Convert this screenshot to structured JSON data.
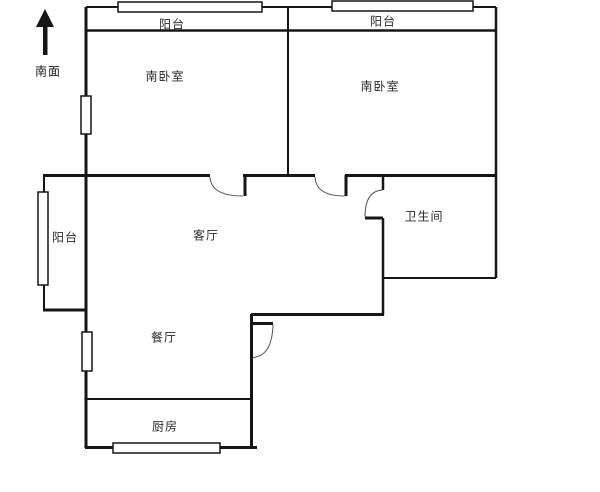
{
  "meta": {
    "type": "floor-plan",
    "orientation_note": "arrow points toward labeled side"
  },
  "compass": {
    "label": "南面",
    "icon": "up-arrow"
  },
  "rooms": {
    "balcony_top_left": {
      "label": "阳台"
    },
    "balcony_top_right": {
      "label": "阳台"
    },
    "bedroom_left": {
      "label": "南卧室"
    },
    "bedroom_right": {
      "label": "南卧室"
    },
    "balcony_left": {
      "label": "阳台"
    },
    "living": {
      "label": "客厅"
    },
    "bathroom": {
      "label": "卫生间"
    },
    "dining": {
      "label": "餐厅"
    },
    "kitchen": {
      "label": "厨房"
    }
  },
  "colors": {
    "wall": "#161616",
    "door_arc": "#555555",
    "background": "#ffffff",
    "text": "#2b2b2b"
  }
}
